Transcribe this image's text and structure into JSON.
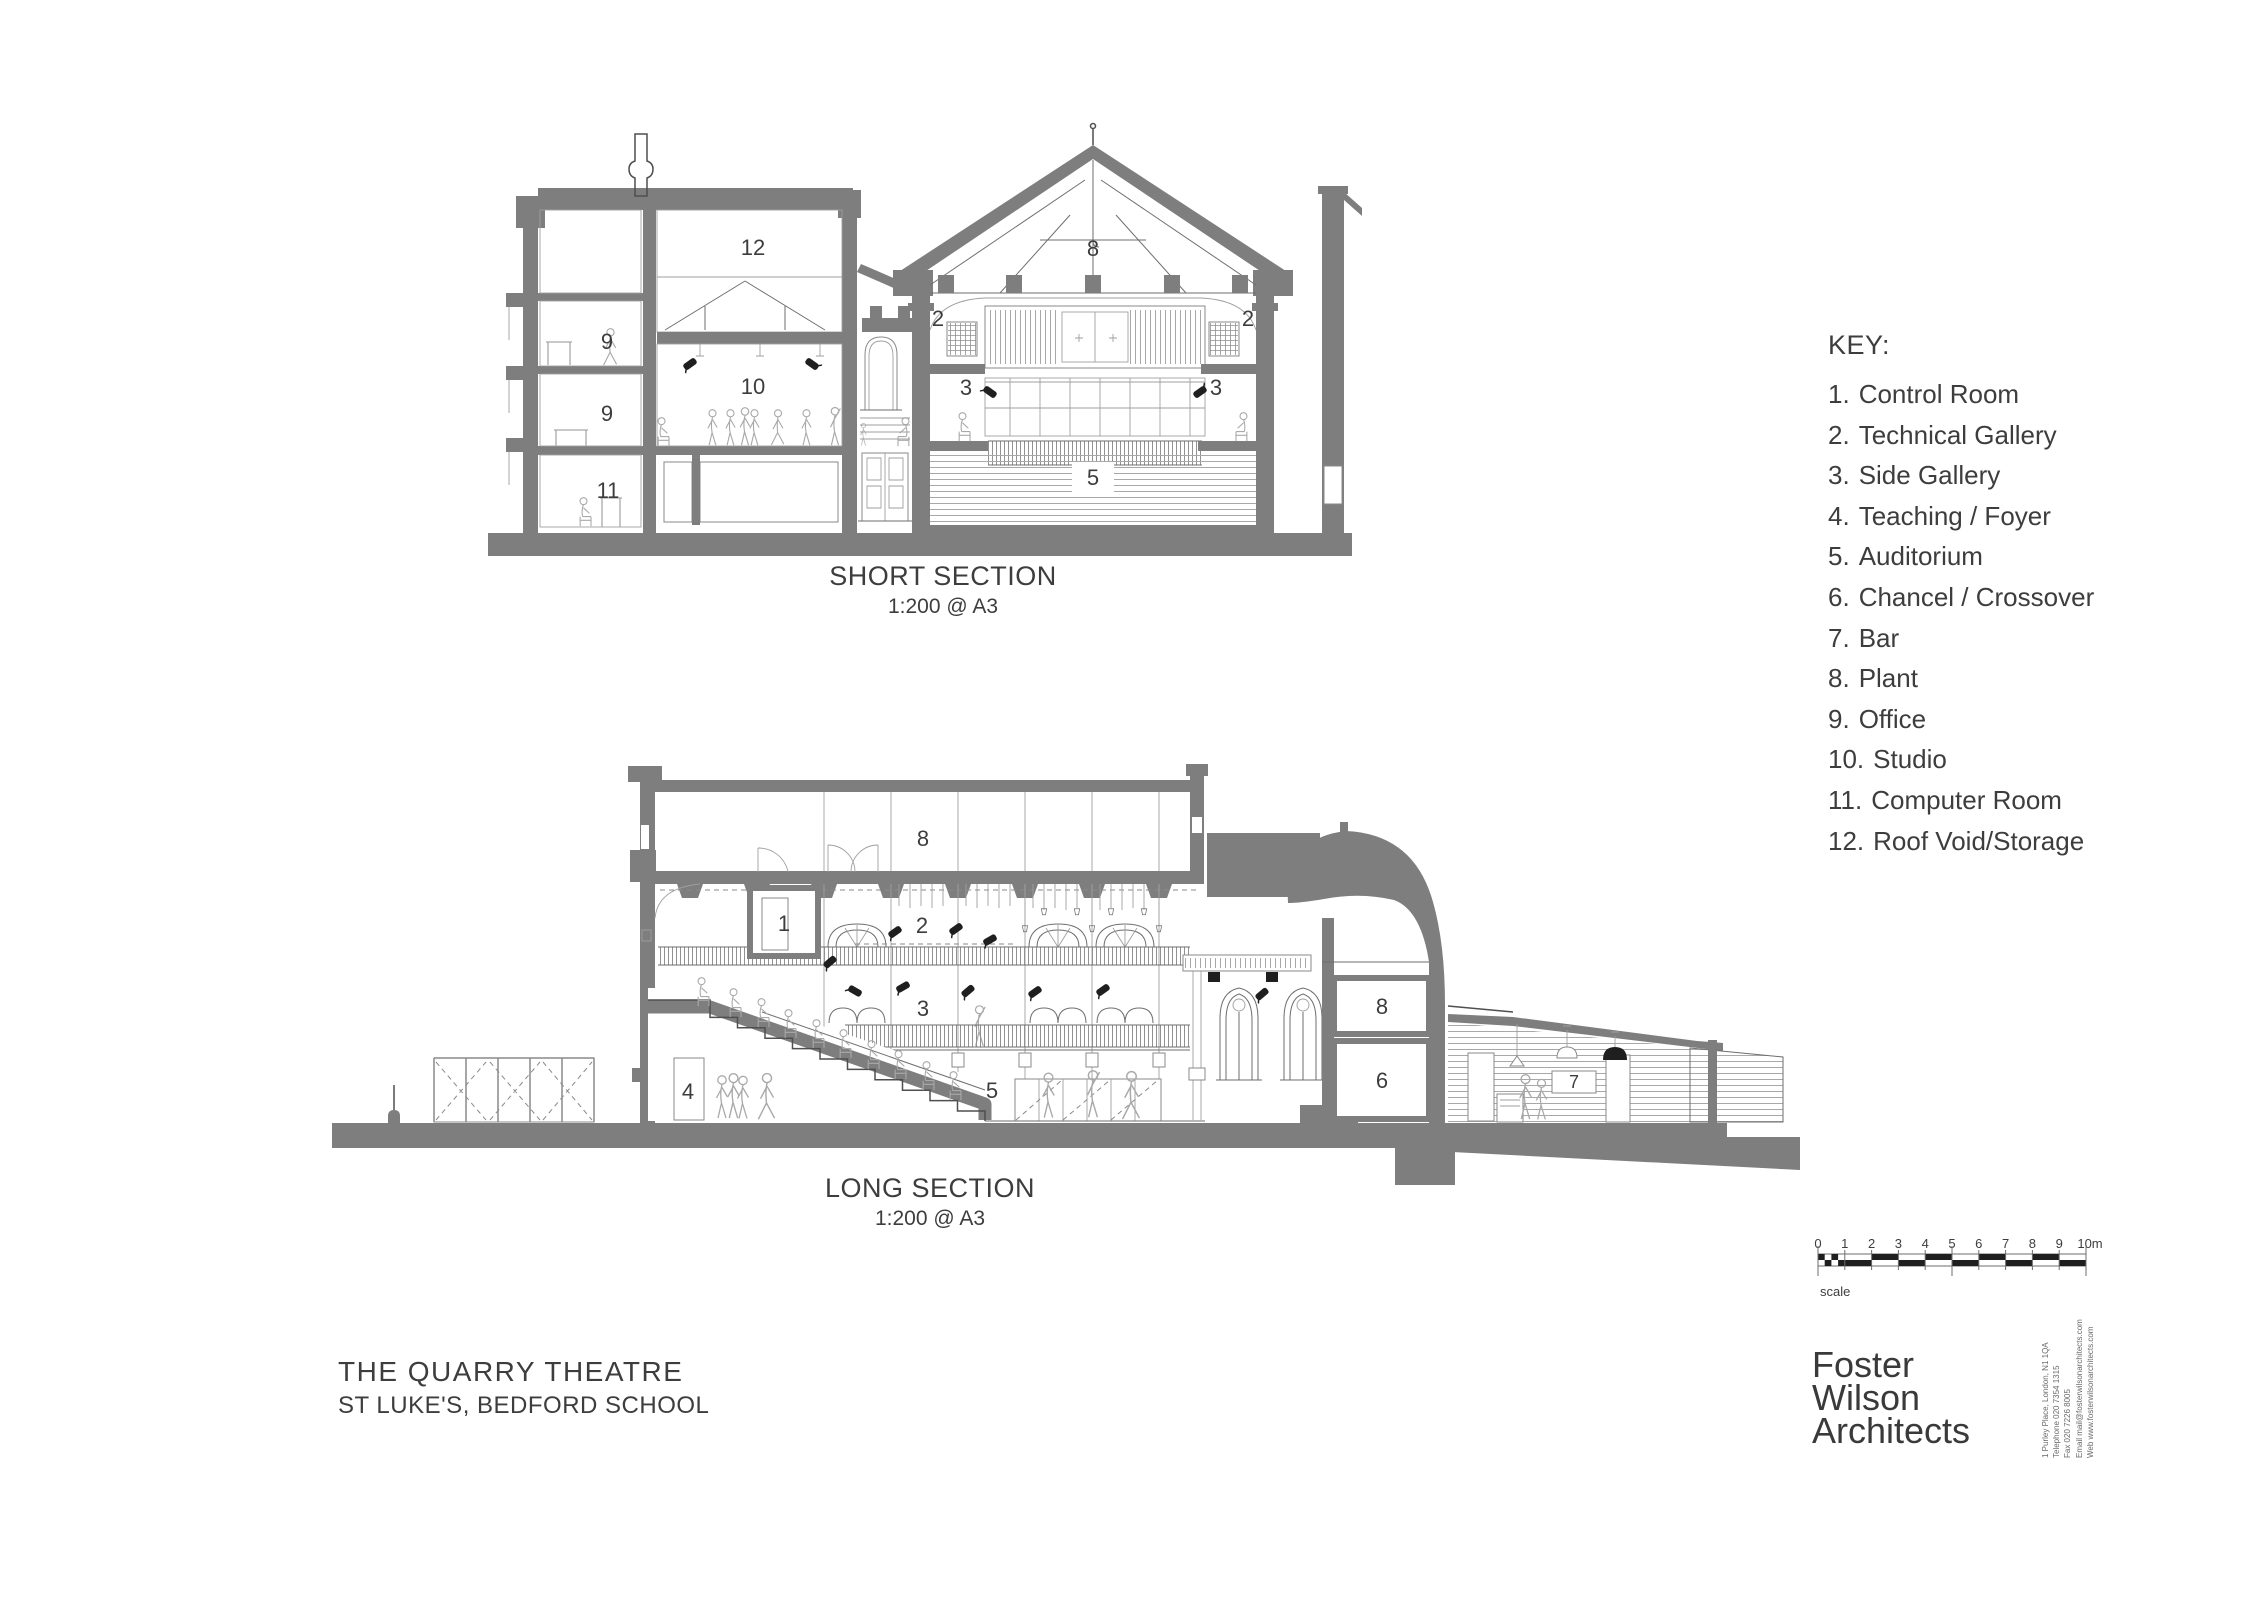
{
  "key": {
    "title": "KEY:",
    "items": [
      {
        "num": "1.",
        "label": "Control Room"
      },
      {
        "num": "2.",
        "label": "Technical Gallery"
      },
      {
        "num": "3.",
        "label": "Side Gallery"
      },
      {
        "num": "4.",
        "label": "Teaching / Foyer"
      },
      {
        "num": "5.",
        "label": "Auditorium"
      },
      {
        "num": "6.",
        "label": "Chancel / Crossover"
      },
      {
        "num": "7.",
        "label": "Bar"
      },
      {
        "num": "8.",
        "label": "Plant"
      },
      {
        "num": "9.",
        "label": "Office"
      },
      {
        "num": "10.",
        "label": "Studio"
      },
      {
        "num": "11.",
        "label": "Computer Room"
      },
      {
        "num": "12.",
        "label": "Roof Void/Storage"
      }
    ]
  },
  "sections": {
    "short": {
      "title": "SHORT SECTION",
      "scale": "1:200 @ A3",
      "labels": {
        "roof_void": "12",
        "office_upper": "9",
        "office_lower": "9",
        "computer_room": "11",
        "studio": "10",
        "plant": "8",
        "tech_gallery_left": "2",
        "tech_gallery_right": "2",
        "side_gallery_left": "3",
        "side_gallery_right": "3",
        "auditorium": "5"
      }
    },
    "long": {
      "title": "LONG SECTION",
      "scale": "1:200 @ A3",
      "labels": {
        "plant": "8",
        "control_room": "1",
        "tech_gallery": "2",
        "side_gallery": "3",
        "auditorium": "5",
        "teaching_foyer": "4",
        "plant_chancel": "8",
        "chancel": "6",
        "bar": "7"
      }
    }
  },
  "project": {
    "title": "THE QUARRY THEATRE",
    "subtitle": "ST LUKE'S, BEDFORD SCHOOL"
  },
  "scale_bar": {
    "ticks": [
      "0",
      "1",
      "2",
      "3",
      "4",
      "5",
      "6",
      "7",
      "8",
      "9",
      "10m"
    ],
    "caption": "scale"
  },
  "firm": {
    "line1": "Foster",
    "line2": "Wilson",
    "line3": "Architects",
    "address": "1 Purley Place, London, N1 1QA",
    "telephone": "Telephone 020 7354 1315",
    "fax": "Fax 020 7226 8005",
    "email": "Email mail@fosterwilsonarchitects.com",
    "web": "Web www.fosterwilsonarchitects.com"
  },
  "colors": {
    "poche": "#7e7e7e",
    "outline": "#4f4f4f",
    "fine_line": "#9f9f9f",
    "text": "#3d3d3d",
    "black": "#1f1f1f",
    "background": "#ffffff"
  }
}
